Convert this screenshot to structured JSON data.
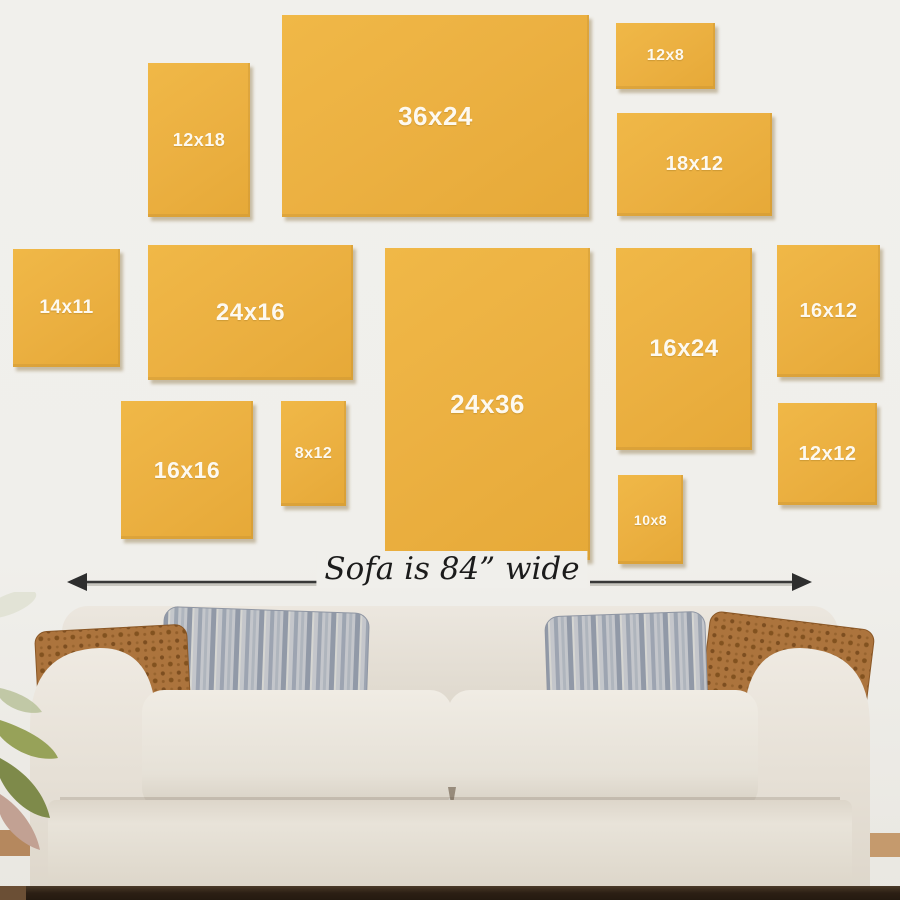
{
  "diagram": {
    "caption": "Sofa is 84” wide",
    "description_note": "canvas size guide above sofa"
  },
  "frames": [
    {
      "label": "12x18"
    },
    {
      "label": "36x24"
    },
    {
      "label": "12x8"
    },
    {
      "label": "18x12"
    },
    {
      "label": "14x11"
    },
    {
      "label": "24x16"
    },
    {
      "label": "16x16"
    },
    {
      "label": "8x12"
    },
    {
      "label": "24x36"
    },
    {
      "label": "16x24"
    },
    {
      "label": "16x12"
    },
    {
      "label": "12x12"
    },
    {
      "label": "10x8"
    }
  ],
  "colors": {
    "wall": "#f0efeb",
    "frame_fill": "#ecb142",
    "frame_label": "#fdf9f0",
    "arrow": "#383838",
    "caption_text": "#1b1b1b",
    "sofa_fabric": "#e9e4db",
    "pillow_rust": "#a9713a",
    "pillow_gray": "#b6bac2",
    "plant_green": "#8a9456",
    "floor_dark": "#2c1f14",
    "floor_wood": "#b5885e"
  }
}
